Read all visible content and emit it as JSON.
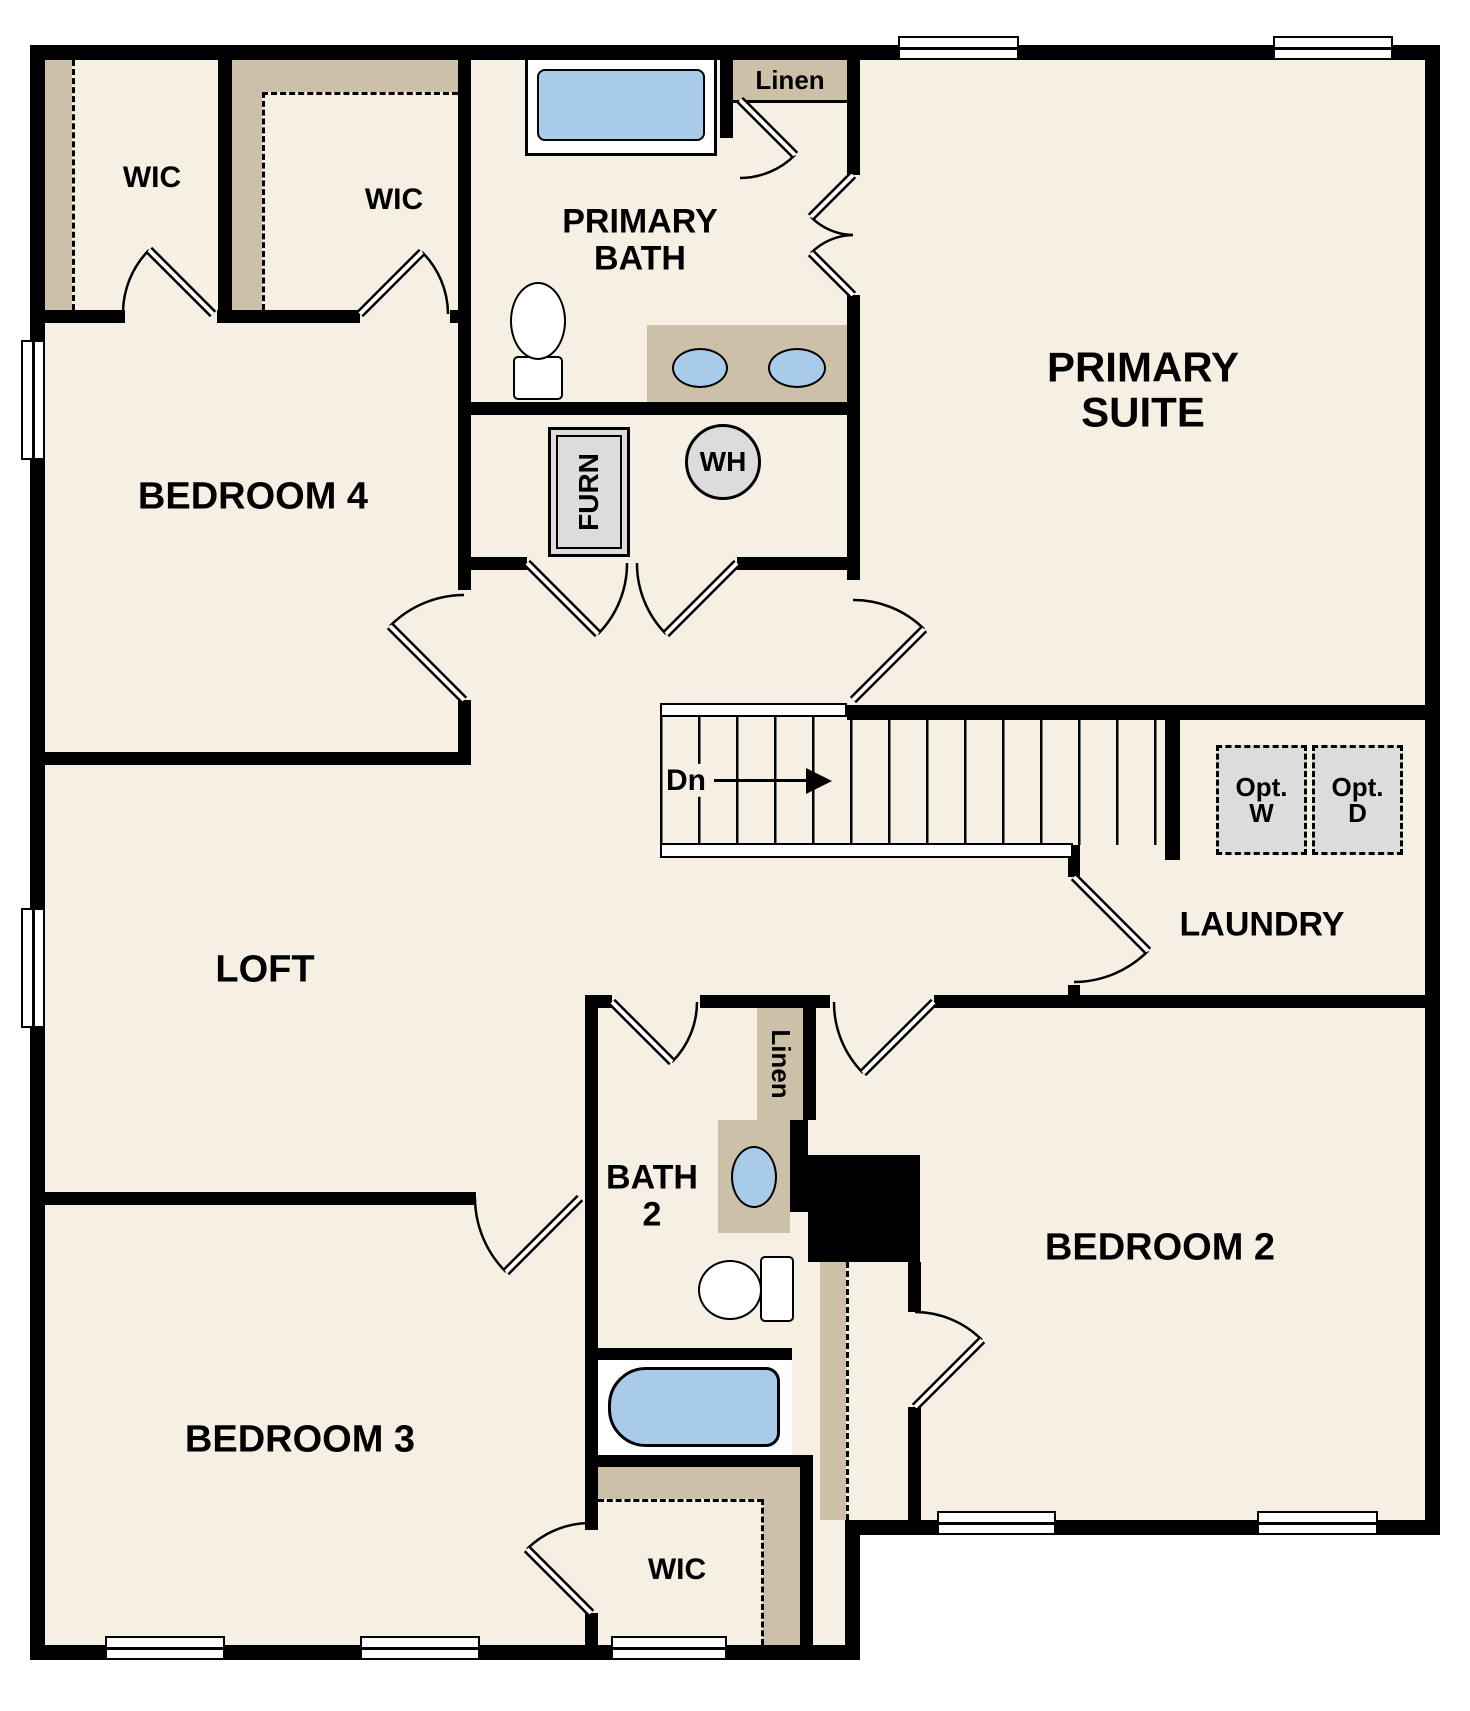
{
  "plan": {
    "rooms": {
      "wic1": {
        "label": "WIC"
      },
      "wic2": {
        "label": "WIC"
      },
      "primary_bath": {
        "line1": "PRIMARY",
        "line2": "BATH"
      },
      "primary_suite": {
        "line1": "PRIMARY",
        "line2": "SUITE"
      },
      "bedroom4": {
        "label": "BEDROOM 4"
      },
      "loft": {
        "label": "LOFT"
      },
      "laundry": {
        "label": "LAUNDRY"
      },
      "bath2": {
        "line1": "BATH",
        "line2": "2"
      },
      "bedroom2": {
        "label": "BEDROOM 2"
      },
      "bedroom3": {
        "label": "BEDROOM 3"
      },
      "wic3": {
        "label": "WIC"
      }
    },
    "closets": {
      "linen_top": "Linen",
      "linen_bath2": "Linen"
    },
    "fixtures": {
      "furnace": "FURN",
      "water_heater": "WH",
      "opt_washer": {
        "line1": "Opt.",
        "line2": "W"
      },
      "opt_dryer": {
        "line1": "Opt.",
        "line2": "D"
      }
    },
    "stairs": {
      "down_label": "Dn"
    },
    "colors": {
      "floor": "#f6efe4",
      "wall": "#000000",
      "shelf": "#ccc1a8",
      "fixture_blue": "#a9cbea",
      "appliance_gray": "#dcdcdc"
    }
  }
}
